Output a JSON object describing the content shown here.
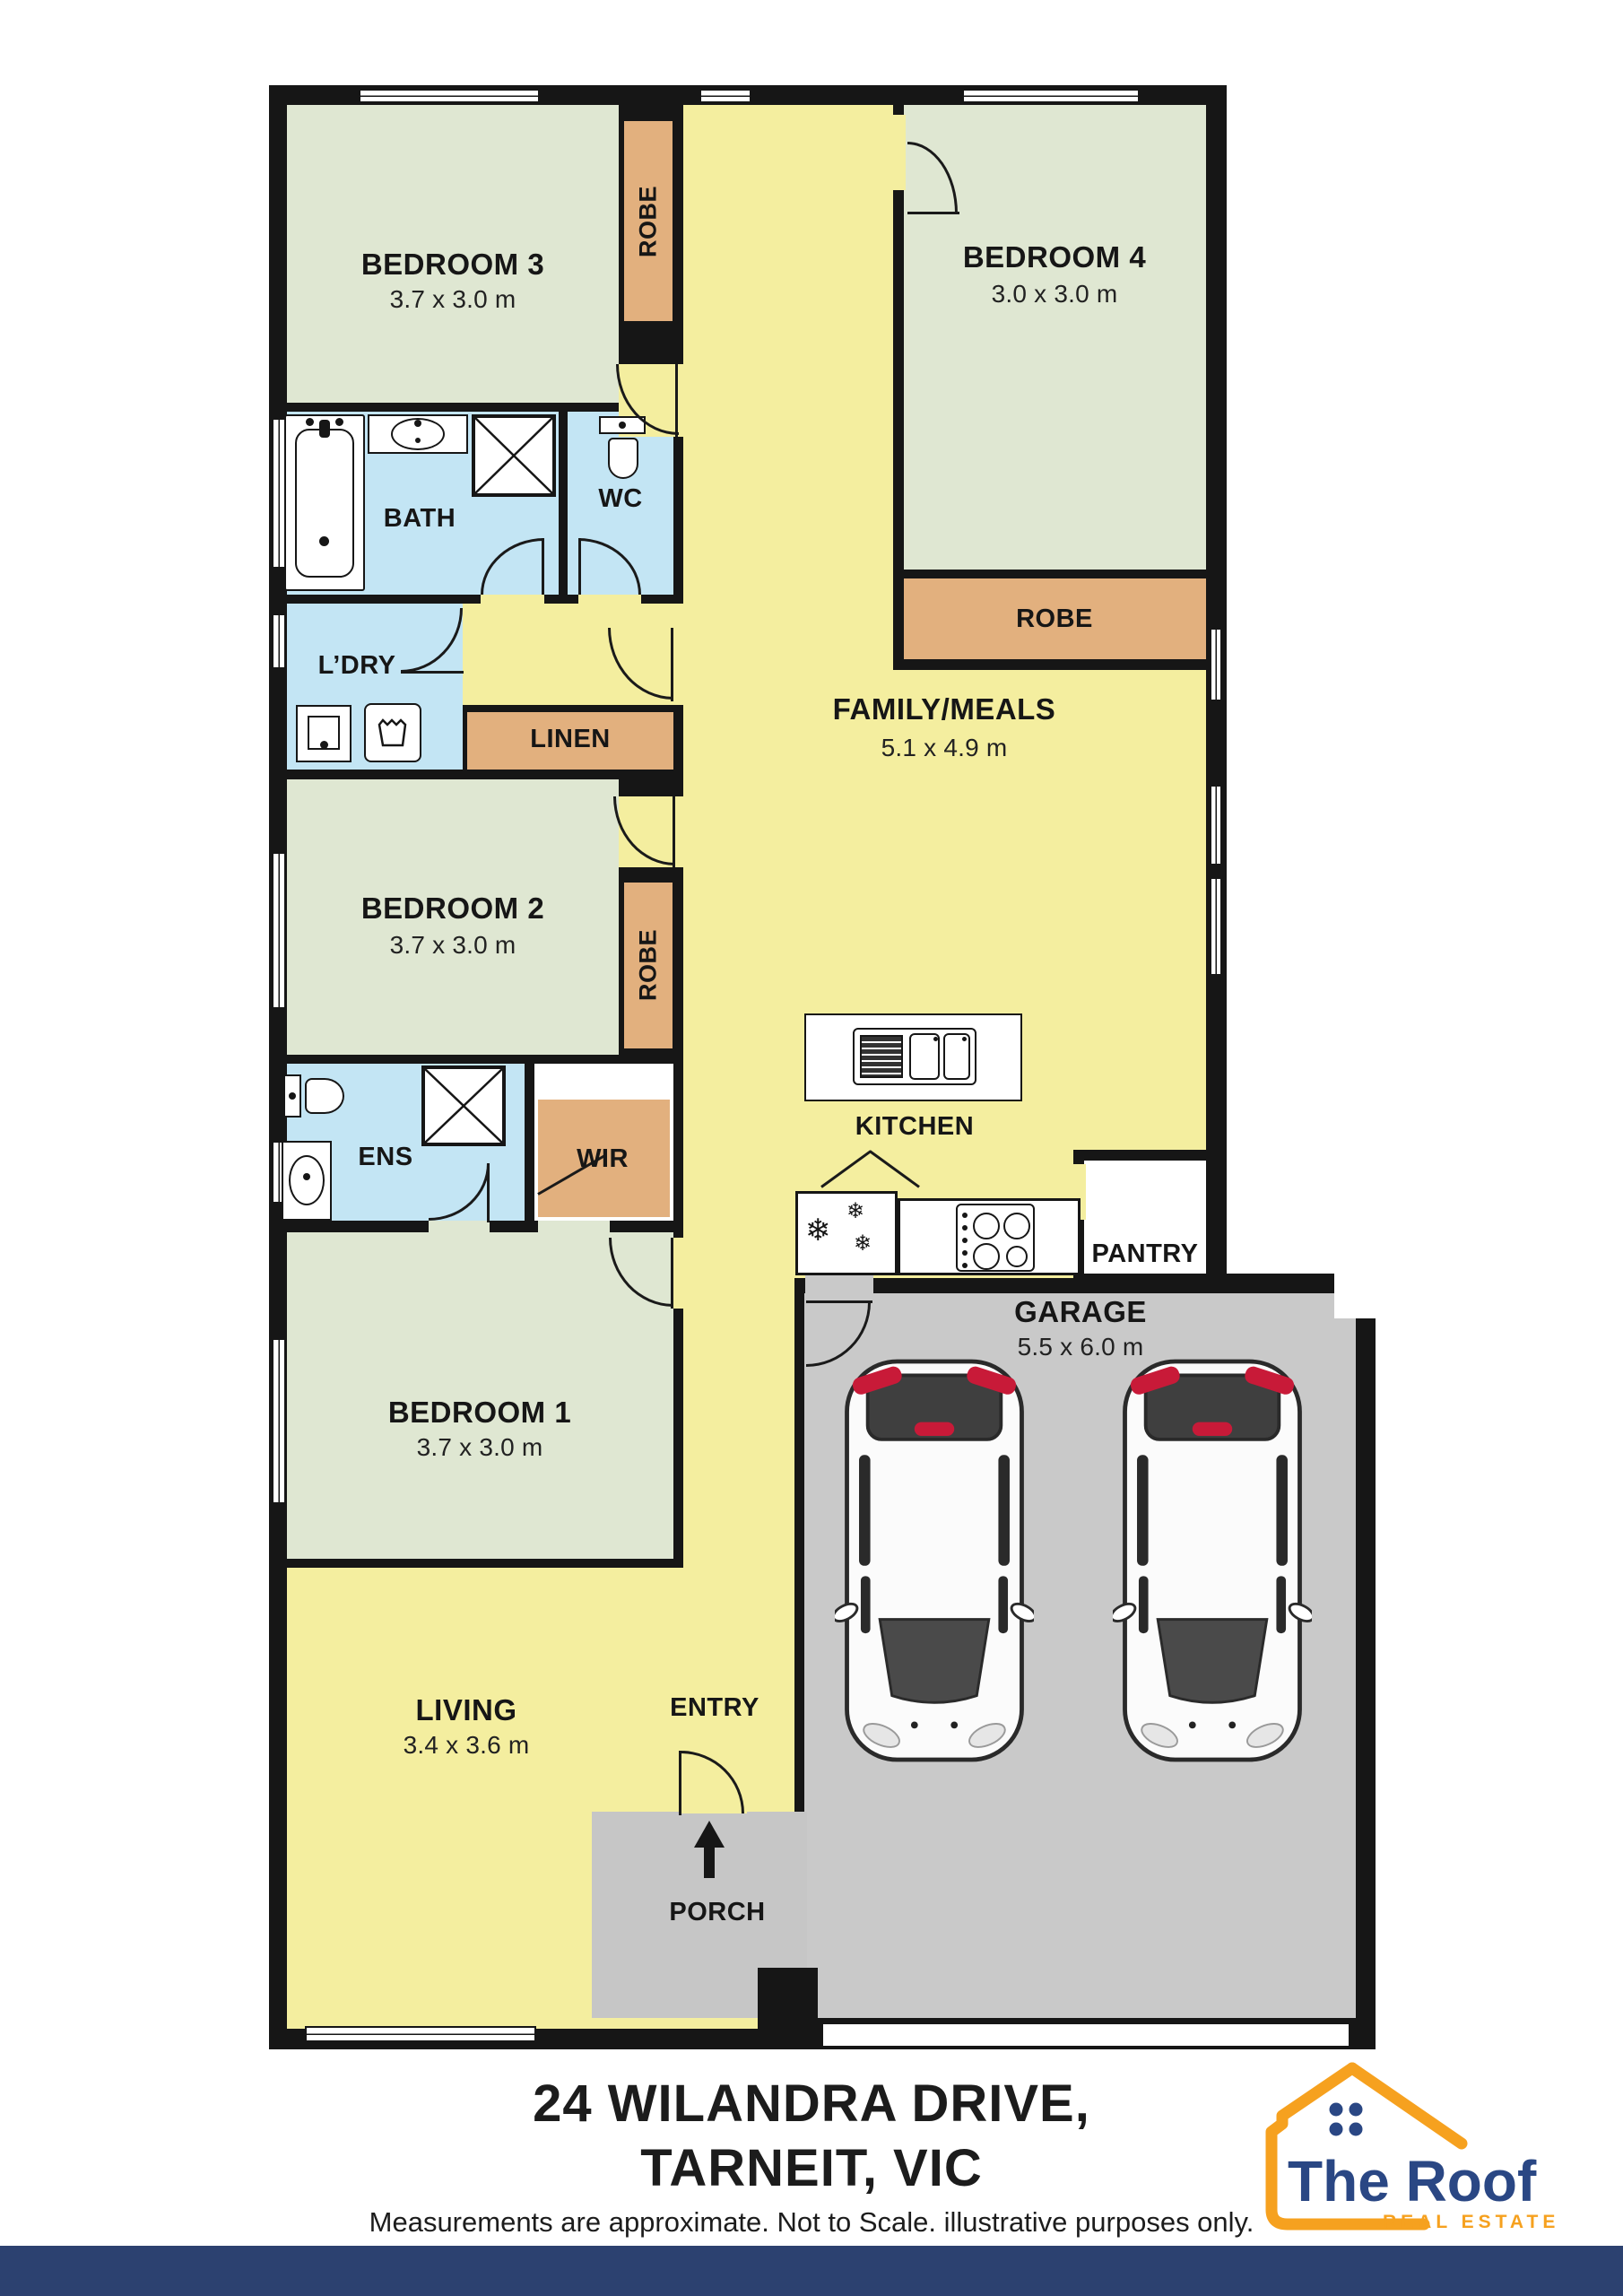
{
  "plan": {
    "rooms": {
      "bedroom3": {
        "label": "BEDROOM 3",
        "dims": "3.7 x 3.0 m"
      },
      "bedroom4": {
        "label": "BEDROOM 4",
        "dims": "3.0 x 3.0 m"
      },
      "family_meals": {
        "label": "FAMILY/MEALS",
        "dims": "5.1 x 4.9 m"
      },
      "bedroom2": {
        "label": "BEDROOM 2",
        "dims": "3.7 x 3.0 m"
      },
      "bedroom1": {
        "label": "BEDROOM 1",
        "dims": "3.7 x 3.0 m"
      },
      "living": {
        "label": "LIVING",
        "dims": "3.4 x 3.6 m"
      },
      "garage": {
        "label": "GARAGE",
        "dims": "5.5 x 6.0 m"
      },
      "kitchen": {
        "label": "KITCHEN"
      },
      "pantry": {
        "label": "PANTRY"
      },
      "bath": {
        "label": "BATH"
      },
      "wc": {
        "label": "WC"
      },
      "laundry": {
        "label": "L’DRY"
      },
      "linen": {
        "label": "LINEN"
      },
      "ensuite": {
        "label": "ENS"
      },
      "wir": {
        "label": "WIR"
      },
      "robe": {
        "label": "ROBE"
      },
      "entry": {
        "label": "ENTRY"
      },
      "porch": {
        "label": "PORCH"
      }
    },
    "icons": {
      "fridge_snowflake": "❄"
    },
    "colors": {
      "bedroom": "#dfe7d2",
      "living_area": "#f4ee9f",
      "wet_area": "#c3e5f4",
      "robe": "#e2b07e",
      "garage": "#c9c9c9",
      "porch": "#c6c6c6",
      "wall": "#161616"
    }
  },
  "footer": {
    "address_line1": "24 WILANDRA DRIVE,",
    "address_line2": "TARNEIT, VIC",
    "disclaimer": "Measurements are approximate. Not to Scale. illustrative purposes only.",
    "bar_color": "#2c4170"
  },
  "logo": {
    "name": "The Roof",
    "tagline": "REAL ESTATE",
    "accent_color": "#f6a11f",
    "navy_color": "#2a4784"
  }
}
